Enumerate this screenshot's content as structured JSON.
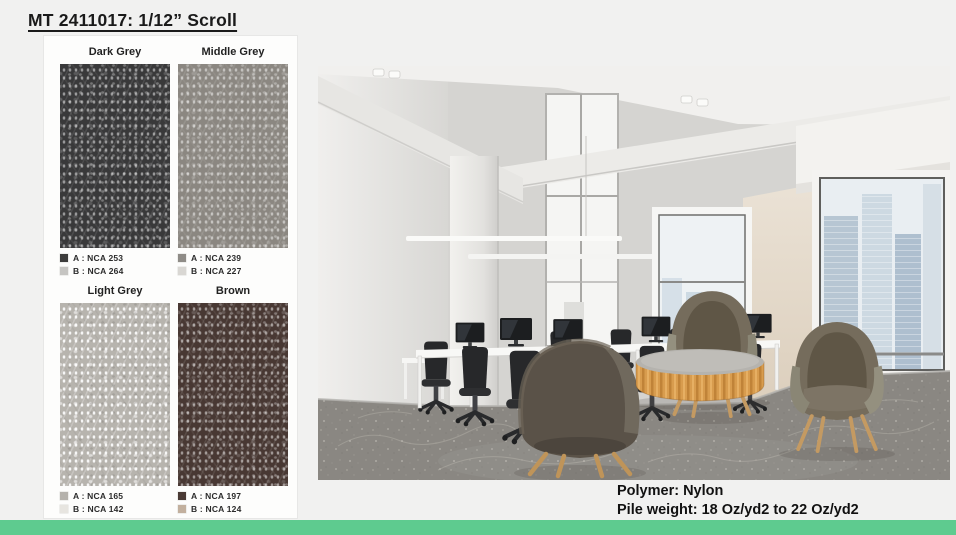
{
  "slide": {
    "title": "MT 2411017: 1/12” Scroll"
  },
  "colors": {
    "accent_green": "#5ecb8f",
    "slide_background": "#f1f1f0",
    "panel_background": "#fdfdfc",
    "carpet_grey": "#8a8782"
  },
  "swatch_panel": {
    "swatches": [
      {
        "name": "Dark Grey",
        "code_a": "A : NCA 253",
        "code_b": "B : NCA 264",
        "chip_a": "#3d3d3c",
        "chip_b": "#c6c5c2",
        "base": "#39393a"
      },
      {
        "name": "Middle Grey",
        "code_a": "A : NCA 239",
        "code_b": "B : NCA 227",
        "chip_a": "#8f8c87",
        "chip_b": "#d9d7d3",
        "base": "#8b8781"
      },
      {
        "name": "Light Grey",
        "code_a": "A : NCA 165",
        "code_b": "B : NCA 142",
        "chip_a": "#b5b2ac",
        "chip_b": "#e7e5e0",
        "base": "#b7b4ae"
      },
      {
        "name": "Brown",
        "code_a": "A : NCA 197",
        "code_b": "B : NCA 124",
        "chip_a": "#4a3a34",
        "chip_b": "#c2b09e",
        "base": "#483833"
      }
    ]
  },
  "specs": {
    "polymer": "Polymer: Nylon",
    "pile_weight": "Pile weight: 18 Oz/yd2 to 22 Oz/yd2"
  }
}
